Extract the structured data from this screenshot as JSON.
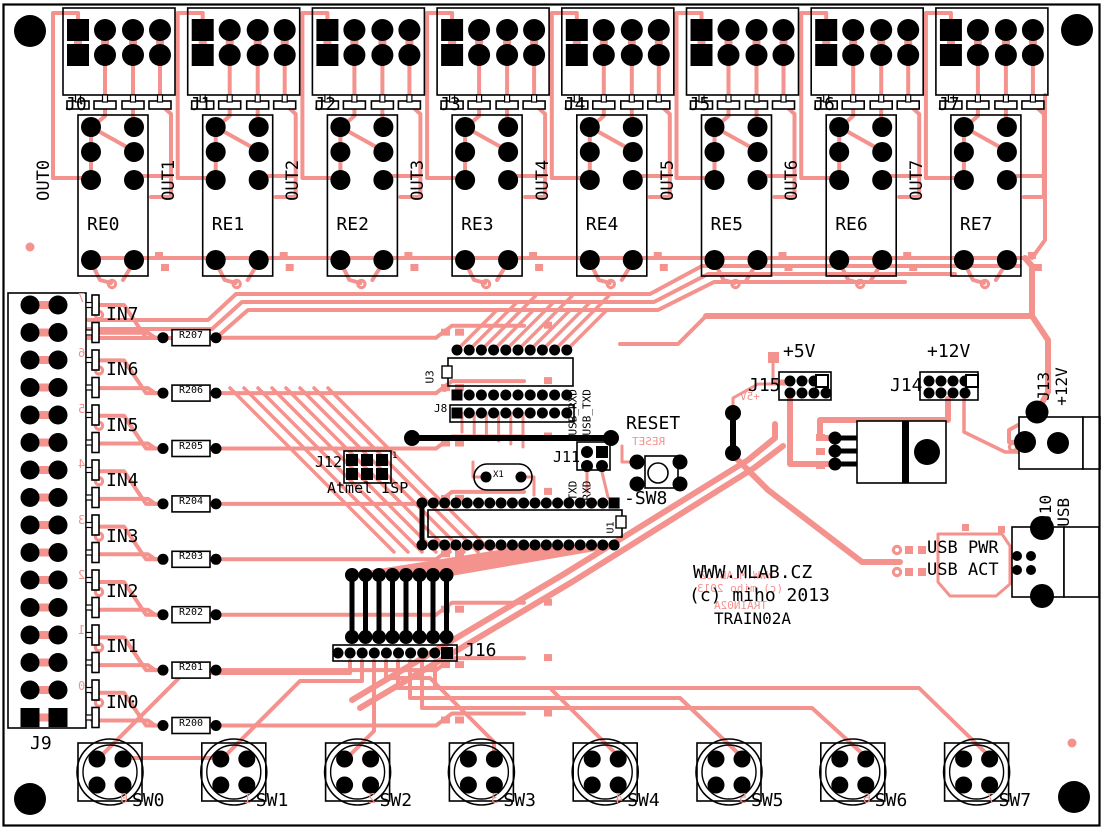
{
  "board": {
    "site": "WWW.MLAB.CZ",
    "copyright": "(c) miho 2013",
    "name": "TRAIN02A",
    "colors": {
      "copper": "#F4928E",
      "silk": "#000000",
      "bg": "#FFFFFF"
    }
  },
  "output_channels": [
    {
      "connector": "J0",
      "relay": "RE0",
      "net": "OUT0"
    },
    {
      "connector": "J1",
      "relay": "RE1",
      "net": "OUT1"
    },
    {
      "connector": "J2",
      "relay": "RE2",
      "net": "OUT2"
    },
    {
      "connector": "J3",
      "relay": "RE3",
      "net": "OUT3"
    },
    {
      "connector": "J4",
      "relay": "RE4",
      "net": "OUT4"
    },
    {
      "connector": "J5",
      "relay": "RE5",
      "net": "OUT5"
    },
    {
      "connector": "J6",
      "relay": "RE6",
      "net": "OUT6"
    },
    {
      "connector": "J7",
      "relay": "RE7",
      "net": "OUT7"
    }
  ],
  "input_header": {
    "name": "J9",
    "pin_digits": [
      "7",
      "6",
      "5",
      "4",
      "3",
      "2",
      "1",
      "0"
    ]
  },
  "input_channels": [
    {
      "net": "IN7",
      "resistor": "R207"
    },
    {
      "net": "IN6",
      "resistor": "R206"
    },
    {
      "net": "IN5",
      "resistor": "R205"
    },
    {
      "net": "IN4",
      "resistor": "R204"
    },
    {
      "net": "IN3",
      "resistor": "R203"
    },
    {
      "net": "IN2",
      "resistor": "R202"
    },
    {
      "net": "IN1",
      "resistor": "R201"
    },
    {
      "net": "IN0",
      "resistor": "R200"
    }
  ],
  "switches": [
    {
      "name": "SW0",
      "digit": "0"
    },
    {
      "name": "SW1",
      "digit": "1"
    },
    {
      "name": "SW2",
      "digit": "2"
    },
    {
      "name": "SW3",
      "digit": "3"
    },
    {
      "name": "SW4",
      "digit": "4"
    },
    {
      "name": "SW5",
      "digit": "5"
    },
    {
      "name": "SW6",
      "digit": "6"
    },
    {
      "name": "SW7",
      "digit": "7"
    }
  ],
  "center": {
    "u3": "U3",
    "u3_pin1": "1",
    "j8": "J8",
    "j12": "J12",
    "j12_pin1": "1",
    "isp": "Atmel ISP",
    "xtal": "X1",
    "j11": "J11",
    "usb_rxd": "USB_RXD",
    "usb_txd": "USB_TXD",
    "txd": "TXD",
    "rxd": "RXD",
    "reset": "RESET",
    "sw8": "-SW8",
    "u1": "U1",
    "j16": "J16"
  },
  "power": {
    "v5": "+5V",
    "j15": "J15",
    "v12": "+12V",
    "j14": "J14",
    "u4": "U4",
    "j13": "J13",
    "j13_net": "+12V",
    "j10": "J10",
    "j10_net": "USB",
    "usb_pwr": "USB PWR",
    "usb_act": "USB ACT"
  }
}
